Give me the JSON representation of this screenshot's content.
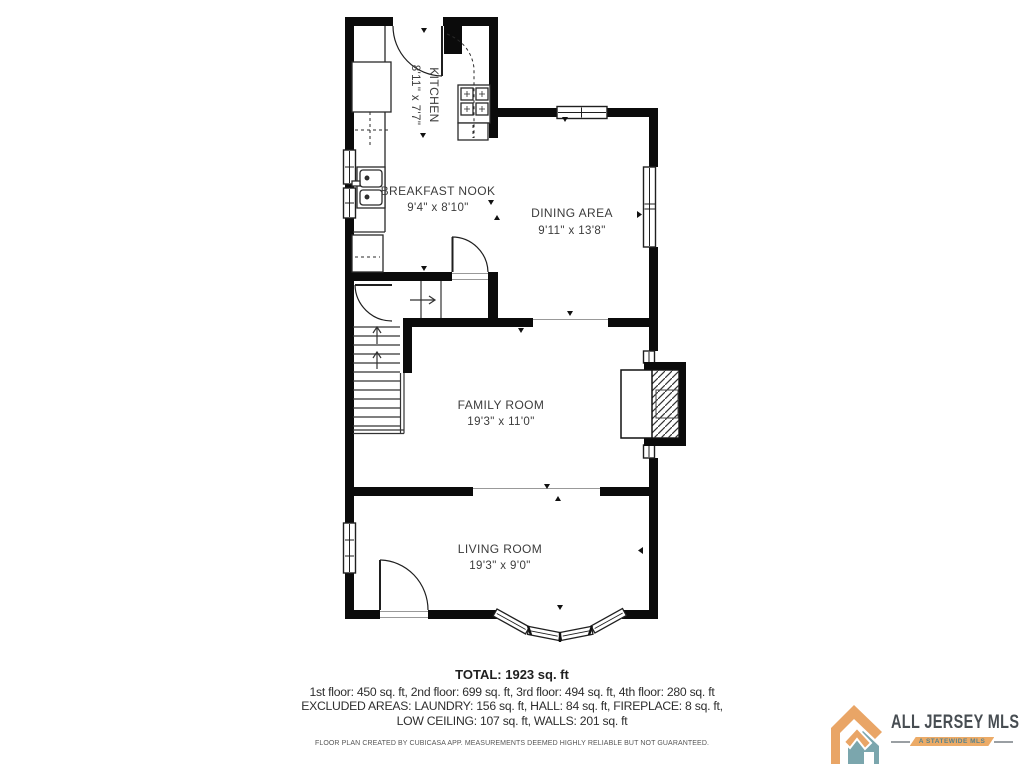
{
  "rooms": [
    {
      "name": "KITCHEN",
      "dims": "8'11\" x 7'7\""
    },
    {
      "name": "BREAKFAST NOOK",
      "dims": "9'4\" x 8'10\""
    },
    {
      "name": "DINING AREA",
      "dims": "9'11\" x 13'8\""
    },
    {
      "name": "FAMILY ROOM",
      "dims": "19'3\" x 11'0\""
    },
    {
      "name": "LIVING ROOM",
      "dims": "19'3\" x 9'0\""
    }
  ],
  "summary": {
    "total": "TOTAL: 1923 sq. ft",
    "floors": "1st floor: 450 sq. ft, 2nd floor: 699 sq. ft, 3rd floor: 494 sq. ft, 4th floor: 280 sq. ft",
    "excluded": "EXCLUDED AREAS: LAUNDRY: 156 sq. ft, HALL: 84 sq. ft, FIREPLACE: 8 sq. ft,",
    "excluded2": "LOW CEILING: 107 sq. ft, WALLS: 201 sq. ft",
    "disclaimer": "FLOOR PLAN CREATED BY CUBICASA APP. MEASUREMENTS DEEMED HIGHLY RELIABLE BUT NOT GUARANTEED."
  },
  "branding": {
    "name": "ALL JERSEY MLS",
    "tagline": "A STATEWIDE MLS",
    "colors": {
      "charcoal": "#474d52",
      "orange": "#e9a566",
      "teal": "#7ba6ad"
    }
  },
  "colors": {
    "wall": "#0b0b0b",
    "line": "#2b2b2b",
    "label": "#3c3c3c",
    "background": "#ffffff"
  }
}
